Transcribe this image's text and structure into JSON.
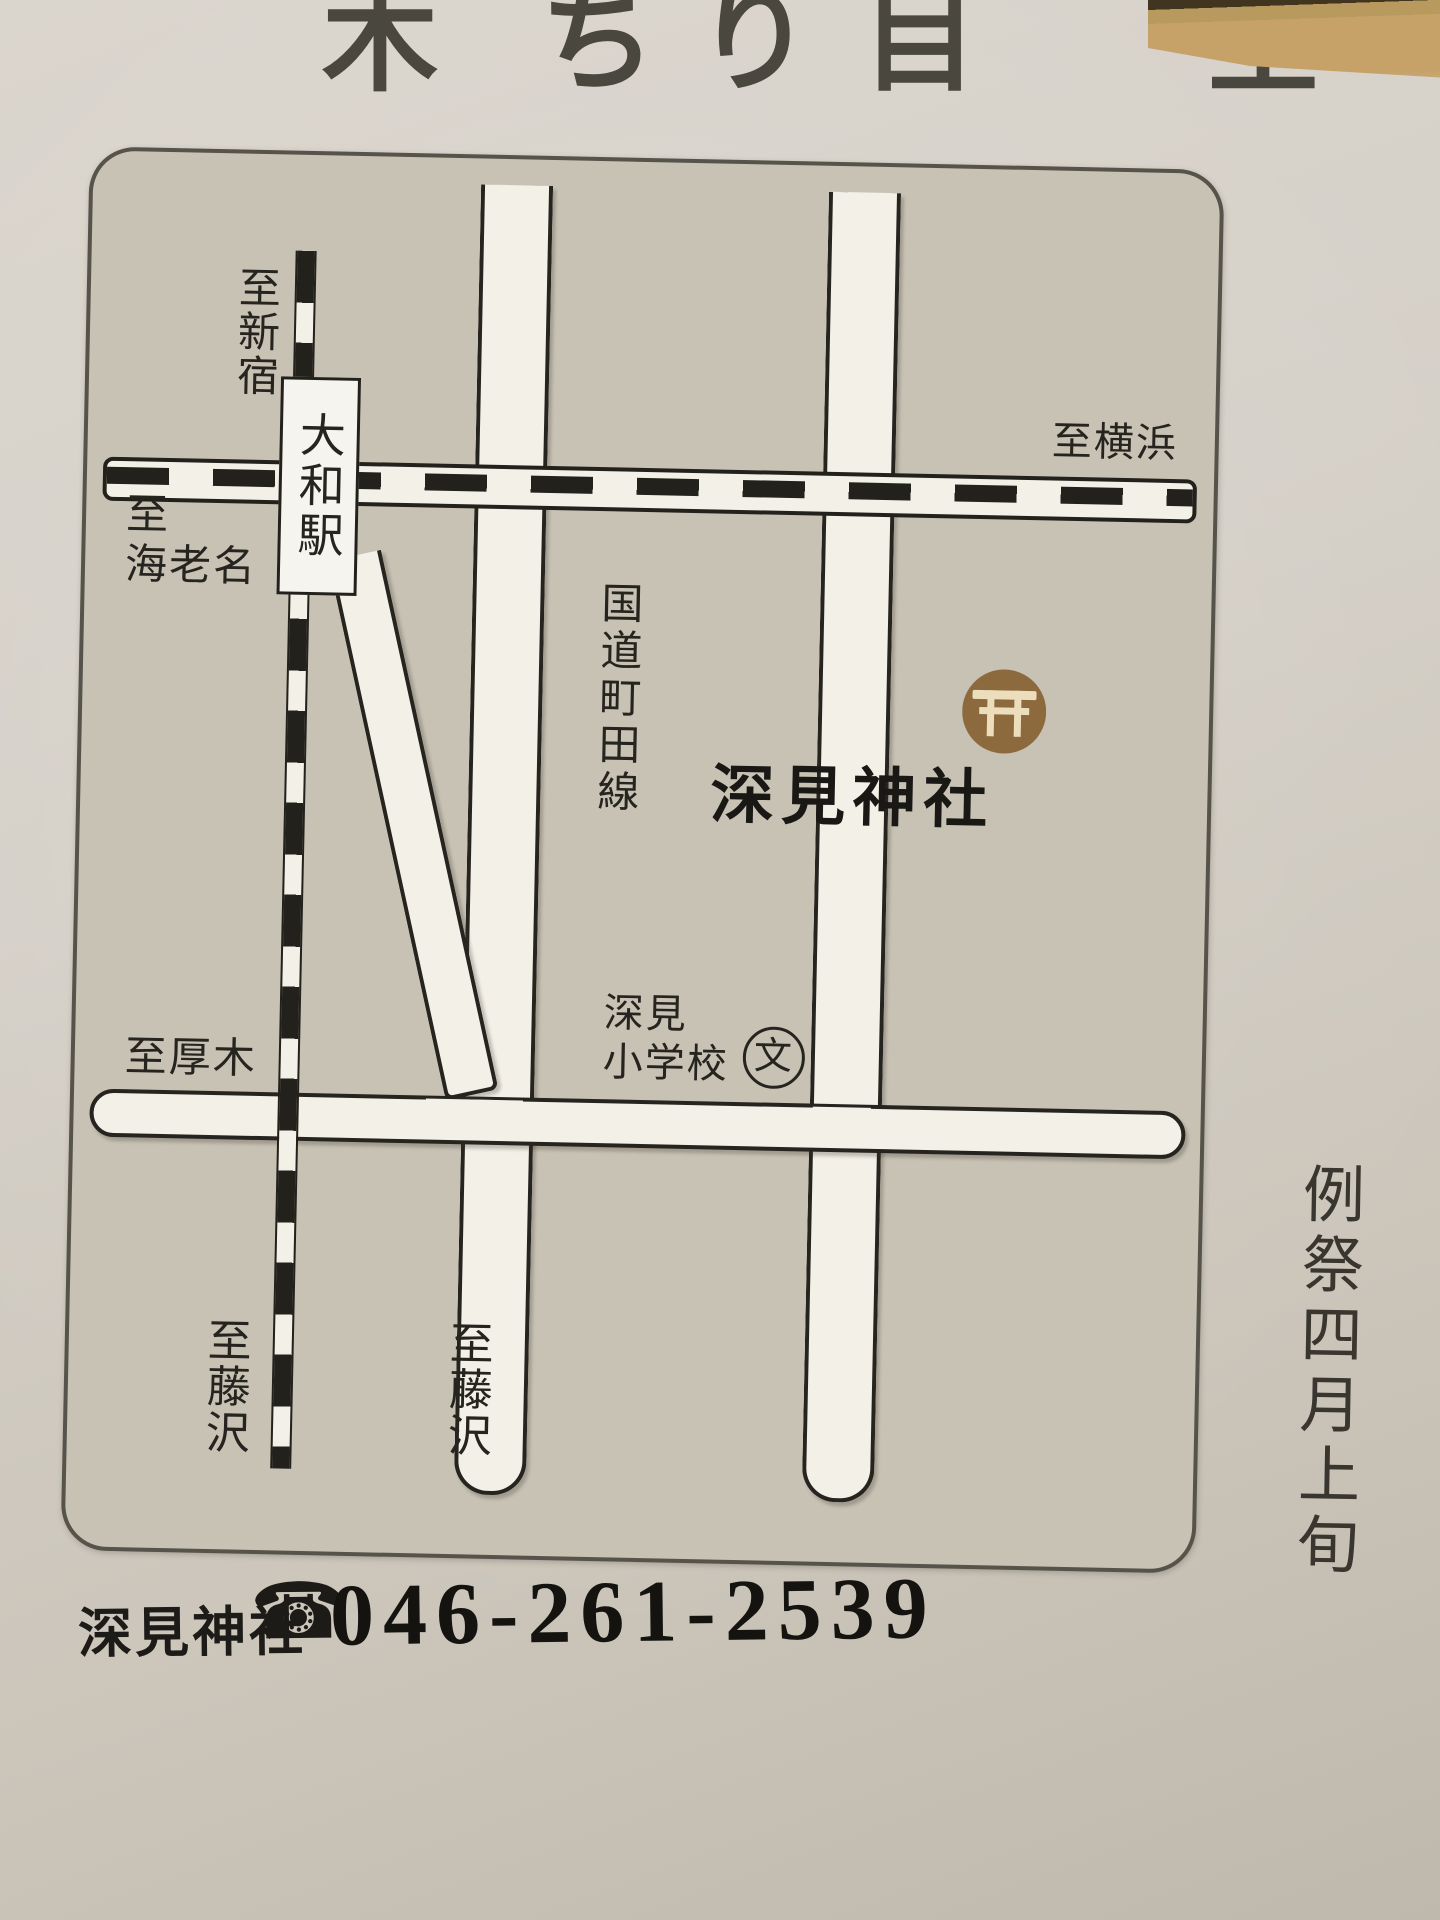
{
  "top_strip": {
    "fragments": [
      "木",
      "ち",
      "り",
      "目",
      "全"
    ]
  },
  "photo_fragment": {
    "description": "sepia-photo-corner"
  },
  "map": {
    "labels": {
      "to_shinjuku": "至新宿",
      "station": "大和駅",
      "to_yokohama": "至横浜",
      "to_ebina_l1": "至",
      "to_ebina_l2": "海老名",
      "route_name": "国道町田線",
      "school_l1": "深見",
      "school_l2": "小学校",
      "school_symbol": "文",
      "shrine": "深見神社",
      "to_atsugi": "至厚木",
      "to_fujisawa_rail": "至藤沢",
      "to_fujisawa_road": "至藤沢"
    },
    "colors": {
      "map_bg": "#c8c2b5",
      "road_white": "#f3f0e7",
      "line_black": "#23211c",
      "torii_brown": "#8d6a3e",
      "torii_glyph": "#ecdebc"
    }
  },
  "footer": {
    "name": "深見神社",
    "phone_icon": "☎",
    "phone": "046-261-2539"
  },
  "side_note": "例祭四月上旬"
}
